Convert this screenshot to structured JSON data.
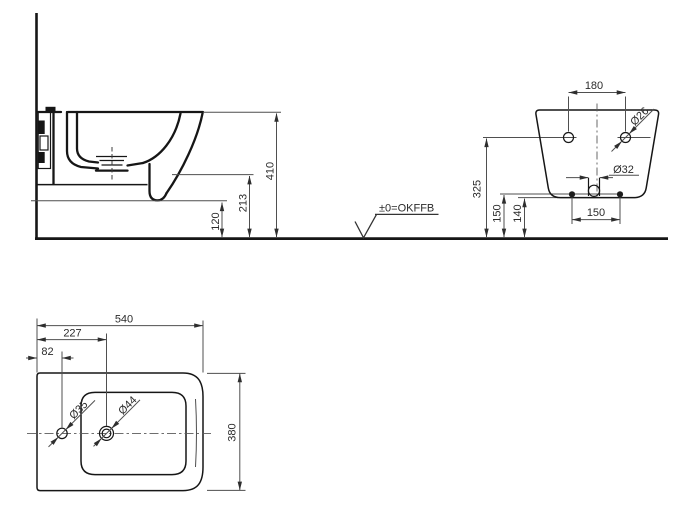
{
  "colors": {
    "background": "#ffffff",
    "object_line": "#161616",
    "dimension_line": "#4f4f4f",
    "text": "#2b2b2b"
  },
  "side_view": {
    "datum_label": "±0=OKFFB",
    "dims": {
      "overall_height": "410",
      "underside_height": "213",
      "outlet_height": "120"
    }
  },
  "rear_view": {
    "dims": {
      "fixing_hole_spacing": "180",
      "fixing_hole_diameter": "Ø26",
      "drain_diameter": "Ø32",
      "fixing_hole_height": "325",
      "lower_fixing_height": "150",
      "body_bottom_height": "140",
      "lower_fixing_spacing": "150"
    }
  },
  "top_view": {
    "dims": {
      "depth": "540",
      "spray_hole_offset": "227",
      "tap_hole_offset": "82",
      "tap_hole_diameter": "Ø35",
      "spray_hole_diameter": "Ø44",
      "width": "380"
    }
  }
}
